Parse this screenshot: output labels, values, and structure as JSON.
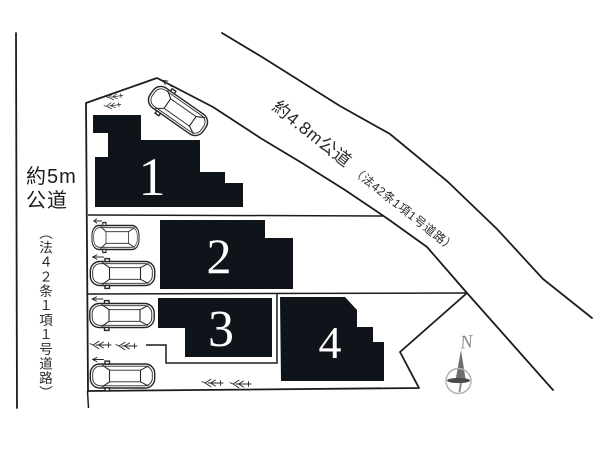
{
  "plan": {
    "title_hint": "site layout drawing",
    "left_road": {
      "label_line1": "約5m",
      "label_line2": "公道",
      "law_note": "（法４２条１項１号道路）"
    },
    "diagonal_road": {
      "label": "約4.8m公道",
      "law_note": "（法42条1項1号道路）"
    },
    "lots": [
      {
        "number": "1"
      },
      {
        "number": "2"
      },
      {
        "number": "3"
      },
      {
        "number": "4"
      }
    ],
    "compass": {
      "north_label": "N"
    },
    "icons": {
      "car": "car-top-view-icon",
      "shrub": "shrub-icon",
      "compass": "compass-needle-icon"
    },
    "colors": {
      "lot_fill": "#0f131a",
      "outline": "#1c1c1c",
      "compass_gray": "#8b8b8b",
      "number_color": "#ffffff"
    }
  }
}
